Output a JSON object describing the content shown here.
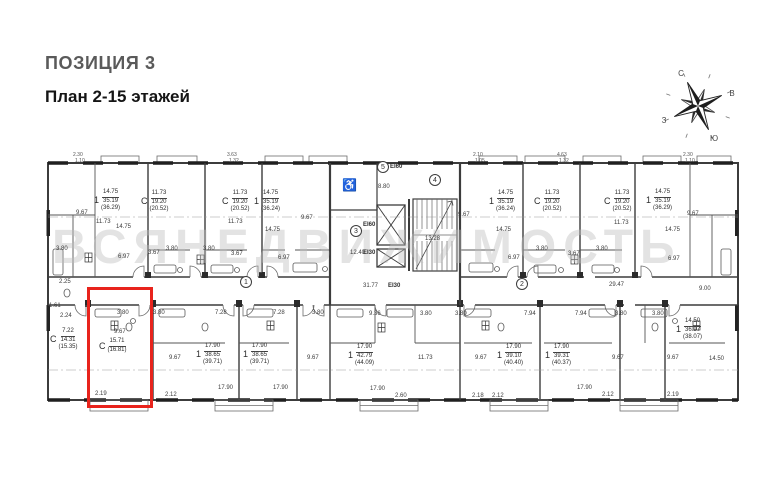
{
  "header": {
    "position": "ПОЗИЦИЯ 3",
    "plan": "План 2-15 этажей"
  },
  "watermark": "ВСЯНЕДВИЖИМОСТЬ",
  "highlight_color": "#e8231c",
  "compass": {
    "n": "С",
    "e": "В",
    "w": "З",
    "s": "Ю"
  },
  "icons": {
    "wheelchair": "♿"
  },
  "apartments": [
    {
      "type": "1",
      "lines": [
        "14.75",
        "35.19",
        "(36.29)"
      ]
    },
    {
      "type": "С",
      "lines": [
        "11.73",
        "19.20",
        "(20.52)"
      ]
    },
    {
      "type": "С",
      "lines": [
        "11.73",
        "19.20",
        "(20.52)"
      ]
    },
    {
      "type": "1",
      "lines": [
        "14.75",
        "35.19",
        "(36.24)"
      ]
    },
    {
      "type": "1",
      "lines": [
        "14.75",
        "35.19",
        "(36.24)"
      ]
    },
    {
      "type": "С",
      "lines": [
        "11.73",
        "19.20",
        "(20.52)"
      ]
    },
    {
      "type": "С",
      "lines": [
        "11.73",
        "19.20",
        "(20.52)"
      ]
    },
    {
      "type": "1",
      "lines": [
        "14.75",
        "35.19",
        "(36.29)"
      ]
    },
    {
      "type": "С",
      "lines": [
        "7.22",
        "14.31",
        "(15.35)"
      ]
    },
    {
      "type": "С",
      "lines": [
        "15.71",
        "(16.81)"
      ]
    },
    {
      "type": "1",
      "lines": [
        "17.90",
        "38.65",
        "(39.71)"
      ]
    },
    {
      "type": "1",
      "lines": [
        "17.90",
        "38.65",
        "(39.71)"
      ]
    },
    {
      "type": "1",
      "lines": [
        "17.90",
        "42.79",
        "(44.09)"
      ]
    },
    {
      "type": "1",
      "lines": [
        "17.90",
        "39.10",
        "(40.40)"
      ]
    },
    {
      "type": "1",
      "lines": [
        "17.90",
        "39.31",
        "(40.37)"
      ]
    },
    {
      "type": "1",
      "lines": [
        "14.50",
        "36.97",
        "(38.07)"
      ]
    }
  ],
  "dims": [
    "9.67",
    "11.73",
    "14.75",
    "3.80",
    "6.97",
    "3.67",
    "3.80",
    "3.80",
    "11.73",
    "3.67",
    "14.75",
    "6.97",
    "9.67",
    "8.80",
    "12.40",
    "13.28",
    "9.67",
    "14.75",
    "6.97",
    "3.80",
    "3.67",
    "3.80",
    "11.73",
    "14.75",
    "6.97",
    "9.67",
    "31.77",
    "29.47",
    "9.00",
    "2.25",
    "1.61",
    "2.24",
    "3.80",
    "3.80",
    "9.67",
    "2.19",
    "7.28",
    "7.28",
    "3.80",
    "9.67",
    "9.67",
    "17.90",
    "17.90",
    "2.12",
    "9.36",
    "3.80",
    "3.80",
    "11.73",
    "9.67",
    "17.90",
    "2.60",
    "2.18",
    "2.12",
    "7.94",
    "7.94",
    "3.80",
    "3.80",
    "9.67",
    "9.67",
    "17.90",
    "2.12",
    "2.19",
    "14.50"
  ],
  "edge_dims": [
    "2.30",
    "1.10",
    "3.63",
    "1.32",
    "2.10",
    "1.05",
    "4.63",
    "1.32",
    "2.30",
    "1.10"
  ],
  "fire_ratings": [
    "EI60",
    "EI60",
    "EI30",
    "EI30"
  ],
  "entries": [
    "1",
    "2",
    "3",
    "4",
    "5"
  ]
}
